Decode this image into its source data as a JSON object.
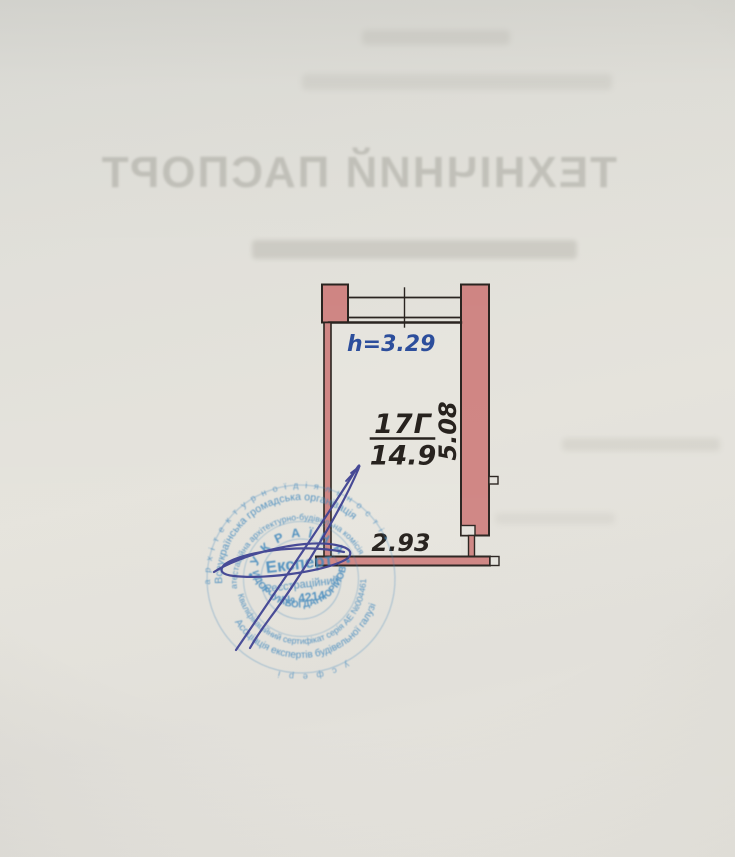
{
  "document": {
    "bleedthrough_title": "ТЕХНІЧНИЙ ПАСПОРТ"
  },
  "plan": {
    "height_label": "h=3.29",
    "room_number": "17Г",
    "room_area": "14.9",
    "dim_right": "5.08",
    "dim_bottom": "2.93",
    "wall_fill": "#cf8583",
    "outline_color": "#29231f",
    "height_label_color": "#2b4d9b"
  },
  "stamp": {
    "ink_color": "#3e86bc",
    "outer_ring_top": "а р х і т е к т у р н о ї   д і я л ь н о с т і   •",
    "outer_ring_bottom": "у   с ф е р і",
    "ring1_top": "Всеукраїнська громадська організація",
    "ring1_bottom": "Асоціація експертів будівельної галузі",
    "ring2_top": "атестаційна архітектурно-будівельна комісія",
    "ring2_bottom": "Кваліфікаційний сертифікат серія АЕ №004461",
    "country": "•  У К Р А Ї Н А  •",
    "expert_name": "СИДОРЧУК  БОГДАН  ЮРІЙОВИЧ",
    "center_title": "Експерт",
    "center_sub": "Реєстраційний",
    "center_number": "№ 4214"
  }
}
